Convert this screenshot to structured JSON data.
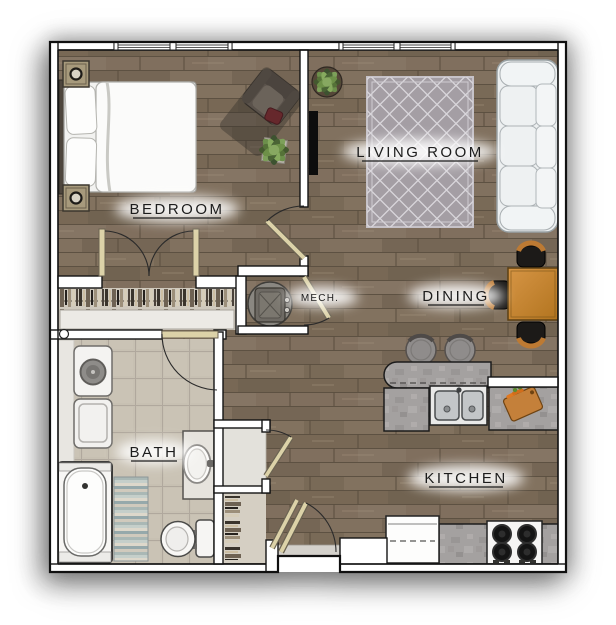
{
  "rooms": {
    "bedroom": {
      "label": "BEDROOM",
      "underlined": true
    },
    "living": {
      "label": "LIVING ROOM",
      "underlined": true
    },
    "dining": {
      "label": "DINING",
      "underlined": true
    },
    "kitchen": {
      "label": "KITCHEN",
      "underlined": true
    },
    "bath": {
      "label": "BATH",
      "underlined": true
    },
    "mech": {
      "label": "MECH.",
      "underlined": false
    }
  },
  "furniture": {
    "bedroom": [
      "queen-bed",
      "nightstand",
      "nightstand",
      "armchair",
      "potted-plant",
      "closet-double-doors",
      "hanging-clothes-rod",
      "closet-shelf"
    ],
    "living_room": [
      "sofa",
      "area-rug",
      "wall-tv",
      "potted-plant"
    ],
    "dining": [
      "dining-table",
      "dining-chair",
      "dining-chair",
      "dining-chair"
    ],
    "kitchen": [
      "breakfast-bar",
      "bar-stool",
      "bar-stool",
      "double-sink",
      "side-counter",
      "cutting-board",
      "refrigerator",
      "range-cooktop",
      "base-counter"
    ],
    "bath": [
      "washer",
      "dryer",
      "bathtub",
      "bath-mat",
      "toilet",
      "vanity-sink"
    ],
    "mech": [
      "water-heater"
    ],
    "entry": [
      "entry-door",
      "coat-closet",
      "linen-closet"
    ]
  },
  "colors": {
    "floor_wood": "#7c6d5c",
    "floor_tile": "#c7c0b2",
    "wall_fill": "#ffffff",
    "wall_outline": "#141414",
    "label_text": "#1c1c1c",
    "rug": "#a49ea4",
    "sofa": "#eceff0",
    "dining_table": "#c98c42",
    "chair_accent": "#bd7a33",
    "counter": "#a4a1a0",
    "door_leaf": "#dcd2a8",
    "glow": "#ffffff"
  },
  "windows": {
    "count": 2,
    "location": "top-wall"
  }
}
